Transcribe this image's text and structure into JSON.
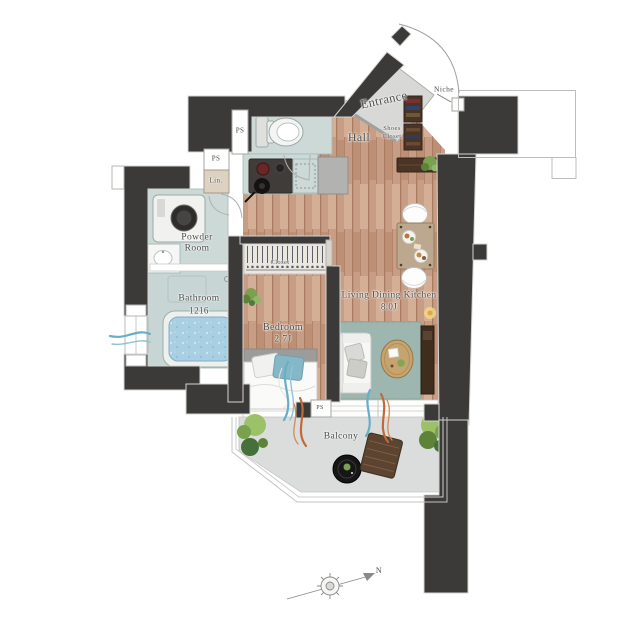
{
  "title": "Apartment floor plan (1K)",
  "labels": {
    "entrance": "Entrance",
    "niche": "Niche",
    "hall": "Hall",
    "shoes_closet_line1": "Shoes",
    "shoes_closet_line2": "Closet",
    "ps": "PS",
    "linen": "Lin.",
    "powder_line1": "Powder",
    "powder_line2": "Room",
    "bathroom": "Bathroom",
    "bathroom_size": "1216",
    "closet": "Closet",
    "bedroom": "Bedroom",
    "bedroom_size": "2.7J",
    "ldk": "Living Dining Kitchen",
    "ldk_size": "8.0J",
    "balcony": "Balcony",
    "north": "N"
  },
  "colors": {
    "wall": "#3b3a38",
    "wood_floor": "#c79e85",
    "wet_room": "#ccd9d7",
    "entrance_floor": "#d8d8d6",
    "balcony_floor": "#dbdddc",
    "bath_water": "#a9cfe2",
    "rug": "#9db7b0",
    "curtain_blue": "#68aec7",
    "curtain_orange": "#bf6a3a",
    "dark_wood_furniture": "#4a3426"
  }
}
